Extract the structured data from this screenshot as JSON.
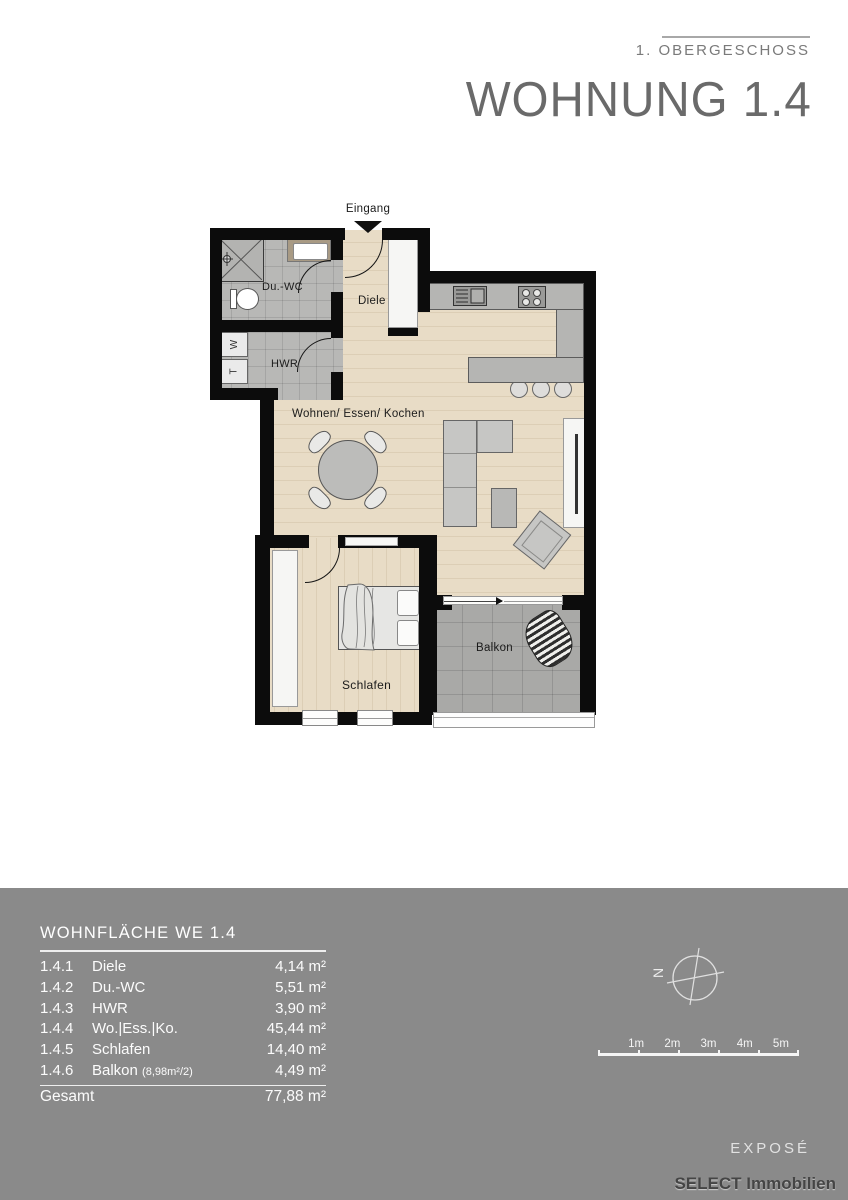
{
  "header": {
    "floor_label": "1. OBERGESCHOSS",
    "title": "WOHNUNG 1.4"
  },
  "plan": {
    "labels": {
      "entrance": "Eingang",
      "duwc": "Du.-WC",
      "hwr": "HWR",
      "diele": "Diele",
      "living": "Wohnen/ Essen/ Kochen",
      "bedroom": "Schlafen",
      "balcony": "Balkon",
      "washer": "W",
      "dryer": "T"
    }
  },
  "area_table": {
    "title": "WOHNFLÄCHE WE 1.4",
    "rows": [
      {
        "no": "1.4.1",
        "name": "Diele",
        "area": "4,14 m²"
      },
      {
        "no": "1.4.2",
        "name": "Du.-WC",
        "area": "5,51 m²"
      },
      {
        "no": "1.4.3",
        "name": "HWR",
        "area": "3,90 m²"
      },
      {
        "no": "1.4.4",
        "name": "Wo.|Ess.|Ko.",
        "area": "45,44 m²"
      },
      {
        "no": "1.4.5",
        "name": "Schlafen",
        "area": "14,40 m²"
      },
      {
        "no": "1.4.6",
        "name": "Balkon",
        "note": "(8,98m²/2)",
        "area": "4,49 m²"
      }
    ],
    "total_label": "Gesamt",
    "total_area": "77,88 m²"
  },
  "compass": {
    "north": "N"
  },
  "scale_bar": {
    "labels": [
      "1m",
      "2m",
      "3m",
      "4m",
      "5m"
    ]
  },
  "footer": {
    "expose": "EXPOSÉ",
    "brand": "SELECT Immobilien"
  },
  "colors": {
    "panel": "#8a8a8a",
    "wall": "#0c0c0c",
    "wood": "#e8dcc6",
    "tile_bath": "#b8b8b6",
    "tile_balcony": "#a9a9a7",
    "counter": "#b5b5b3"
  }
}
